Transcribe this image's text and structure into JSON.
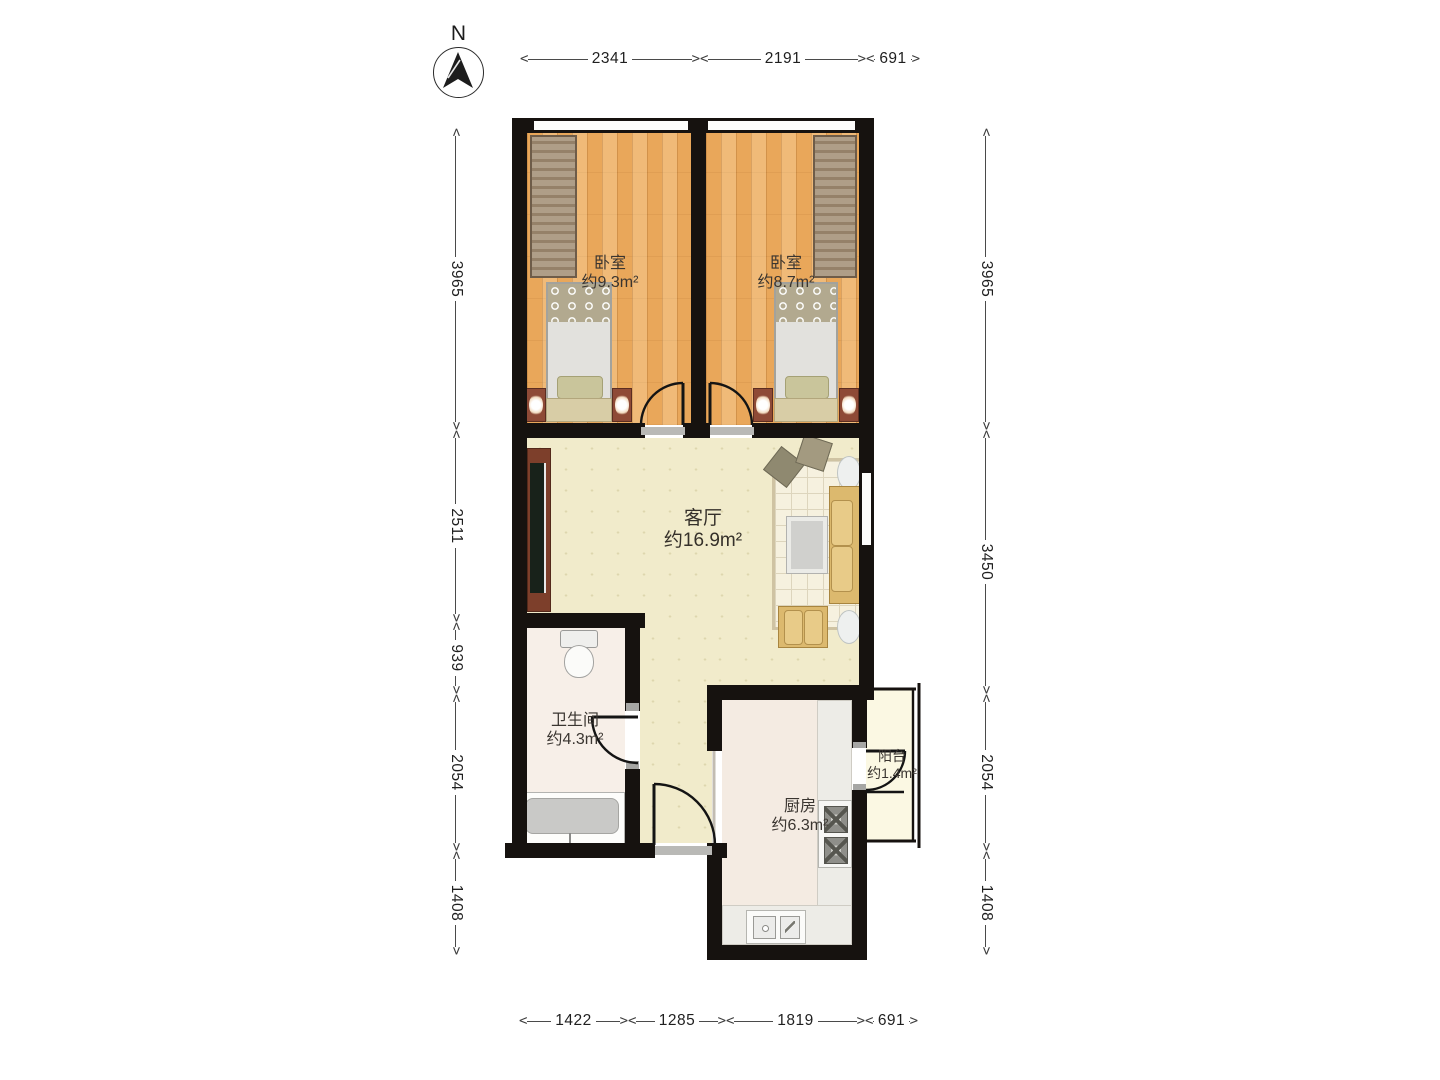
{
  "compass": {
    "label": "N"
  },
  "rooms": {
    "bedroom1": {
      "name": "卧室",
      "area": "约9.3m²"
    },
    "bedroom2": {
      "name": "卧室",
      "area": "约8.7m²"
    },
    "living": {
      "name": "客厅",
      "area": "约16.9m²"
    },
    "bathroom": {
      "name": "卫生间",
      "area": "约4.3m²"
    },
    "kitchen": {
      "name": "厨房",
      "area": "约6.3m²"
    },
    "balcony": {
      "name": "阳台",
      "area": "约1.4m²"
    }
  },
  "dimensions": {
    "top": [
      "2341",
      "2191",
      "691"
    ],
    "bottom": [
      "1422",
      "1285",
      "1819",
      "691"
    ],
    "left": [
      "3965",
      "2511",
      "939",
      "2054",
      "1408"
    ],
    "right": [
      "3965",
      "3450",
      "2054",
      "1408"
    ]
  },
  "colors": {
    "wall": "#16120f",
    "wood_floor": "#e9a75a",
    "living_floor": "#f1ebcb",
    "bath_floor": "#f7efe8",
    "kitchen_floor": "#f4ebe2",
    "balcony_floor": "#fbf8e3",
    "dimension_text": "#1f1f1f"
  }
}
